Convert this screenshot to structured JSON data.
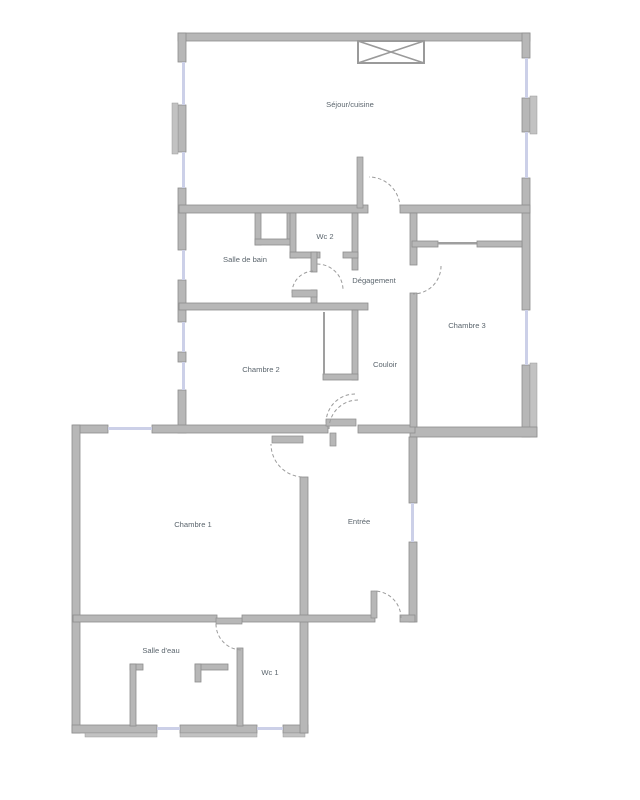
{
  "document": {
    "type": "apartment-floor-plan"
  },
  "rooms": {
    "sejour": {
      "label": "Séjour/cuisine"
    },
    "salle_de_bain": {
      "label": "Salle de bain"
    },
    "wc2": {
      "label": "Wc 2"
    },
    "degagement": {
      "label": "Dégagement"
    },
    "chambre3": {
      "label": "Chambre 3"
    },
    "chambre2": {
      "label": "Chambre 2"
    },
    "couloir": {
      "label": "Couloir"
    },
    "chambre1": {
      "label": "Chambre 1"
    },
    "entree": {
      "label": "Entrée"
    },
    "salle_deau": {
      "label": "Salle d'eau"
    },
    "wc1": {
      "label": "Wc 1"
    }
  },
  "colors": {
    "background": "#ffffff",
    "wall_fill": "#b7b7b7",
    "wall_edge": "#8d8d8d",
    "window_glass": "#ccd0e8",
    "door_arc": "#9b9b9b",
    "label_text": "#5c666e"
  }
}
